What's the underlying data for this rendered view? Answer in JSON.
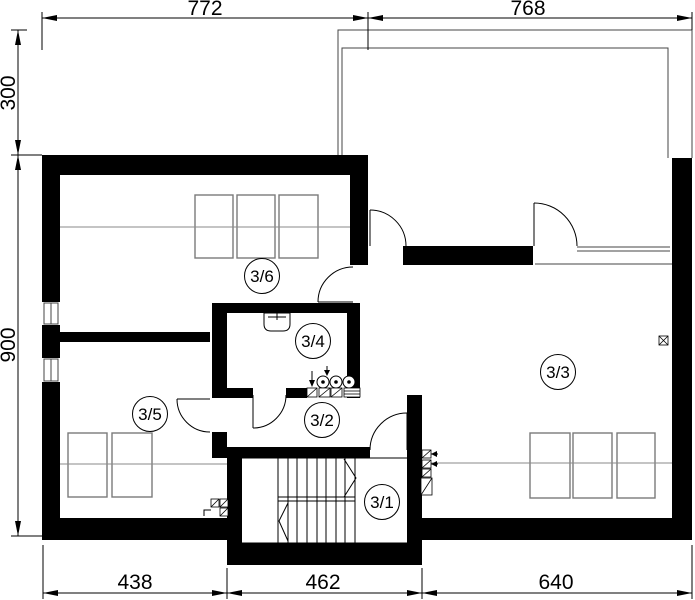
{
  "rooms": [
    {
      "label": "3/6"
    },
    {
      "label": "3/4"
    },
    {
      "label": "3/5"
    },
    {
      "label": "3/2"
    },
    {
      "label": "3/3"
    },
    {
      "label": "3/1"
    }
  ],
  "dimensions": {
    "top": [
      "772",
      "768"
    ],
    "left": [
      "300",
      "900"
    ],
    "bottom": [
      "438",
      "462",
      "640"
    ]
  },
  "colors": {
    "wall": "#000000",
    "thin_line": "#444444",
    "furniture_line": "#7a7a7a",
    "background": "#ffffff"
  }
}
